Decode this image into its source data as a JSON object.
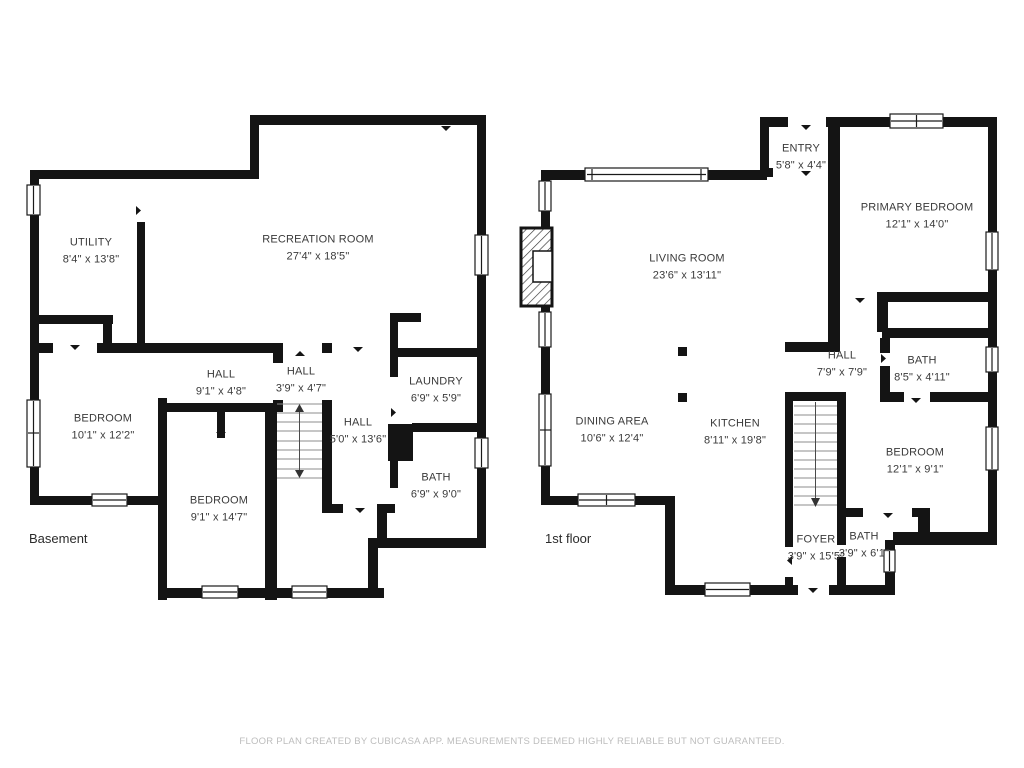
{
  "footer": {
    "text": "FLOOR PLAN CREATED BY CUBICASA APP. MEASUREMENTS DEEMED HIGHLY RELIABLE BUT NOT GUARANTEED."
  },
  "floors": [
    {
      "label": "Basement",
      "rooms": [
        {
          "name": "UTILITY",
          "dims": "8'4\" x 13'8\"",
          "x": 91,
          "y": 251
        },
        {
          "name": "RECREATION ROOM",
          "dims": "27'4\" x 18'5\"",
          "x": 318,
          "y": 248
        },
        {
          "name": "HALL",
          "dims": "9'1\" x 4'8\"",
          "x": 221,
          "y": 383
        },
        {
          "name": "HALL",
          "dims": "3'9\" x 4'7\"",
          "x": 301,
          "y": 380
        },
        {
          "name": "LAUNDRY",
          "dims": "6'9\" x 5'9\"",
          "x": 436,
          "y": 390
        },
        {
          "name": "BEDROOM",
          "dims": "10'1\" x 12'2\"",
          "x": 103,
          "y": 427
        },
        {
          "name": "HALL",
          "dims": "5'0\" x 13'6\"",
          "x": 358,
          "y": 431
        },
        {
          "name": "BATH",
          "dims": "6'9\" x 9'0\"",
          "x": 436,
          "y": 486
        },
        {
          "name": "BEDROOM",
          "dims": "9'1\" x 14'7\"",
          "x": 219,
          "y": 509
        }
      ]
    },
    {
      "label": "1st floor",
      "rooms": [
        {
          "name": "ENTRY",
          "dims": "5'8\" x 4'4\"",
          "x": 801,
          "y": 157
        },
        {
          "name": "PRIMARY BEDROOM",
          "dims": "12'1\" x 14'0\"",
          "x": 917,
          "y": 216
        },
        {
          "name": "LIVING ROOM",
          "dims": "23'6\" x 13'11\"",
          "x": 687,
          "y": 267
        },
        {
          "name": "HALL",
          "dims": "7'9\" x 7'9\"",
          "x": 842,
          "y": 364
        },
        {
          "name": "BATH",
          "dims": "8'5\" x 4'11\"",
          "x": 922,
          "y": 369
        },
        {
          "name": "DINING AREA",
          "dims": "10'6\" x 12'4\"",
          "x": 612,
          "y": 430
        },
        {
          "name": "KITCHEN",
          "dims": "8'11\" x 19'8\"",
          "x": 735,
          "y": 432
        },
        {
          "name": "BEDROOM",
          "dims": "12'1\" x 9'1\"",
          "x": 915,
          "y": 461
        },
        {
          "name": "FOYER",
          "dims": "3'9\" x 15'5\"",
          "x": 816,
          "y": 548
        },
        {
          "name": "BATH",
          "dims": "3'9\" x 6'1\"",
          "x": 864,
          "y": 545
        }
      ]
    }
  ]
}
